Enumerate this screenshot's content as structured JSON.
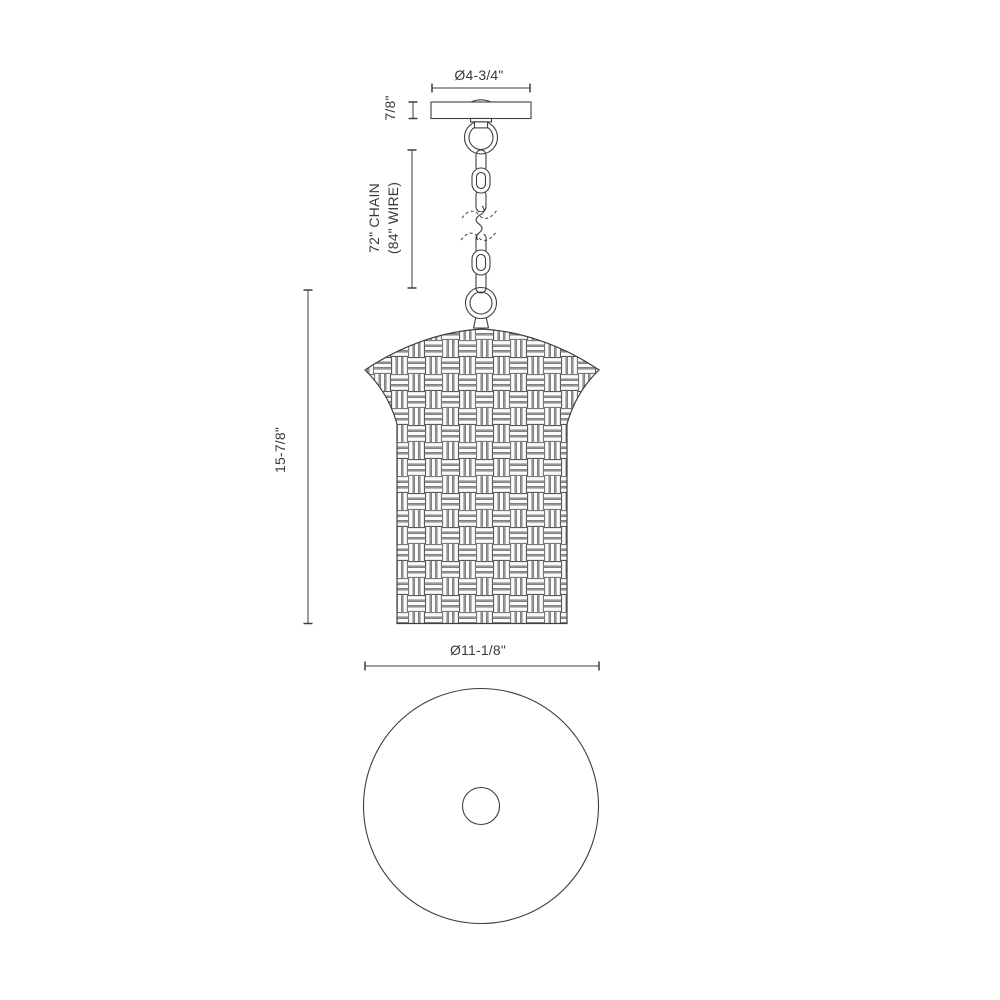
{
  "drawing_type": "pendant-light-dimension-drawing",
  "dimensions": {
    "canopy_diameter": "Ø4-3/4\"",
    "canopy_height": "7/8\"",
    "chain_length": "72\" CHAIN",
    "wire_length": "(84\" WIRE)",
    "fixture_height": "15-7/8\"",
    "shade_diameter": "Ø11-1/8\""
  },
  "colors": {
    "background": "#ffffff",
    "line": "#3f3f3f",
    "weave_gap_gray": "#cbcbcb",
    "weave_slat": "#fbfbfb"
  }
}
